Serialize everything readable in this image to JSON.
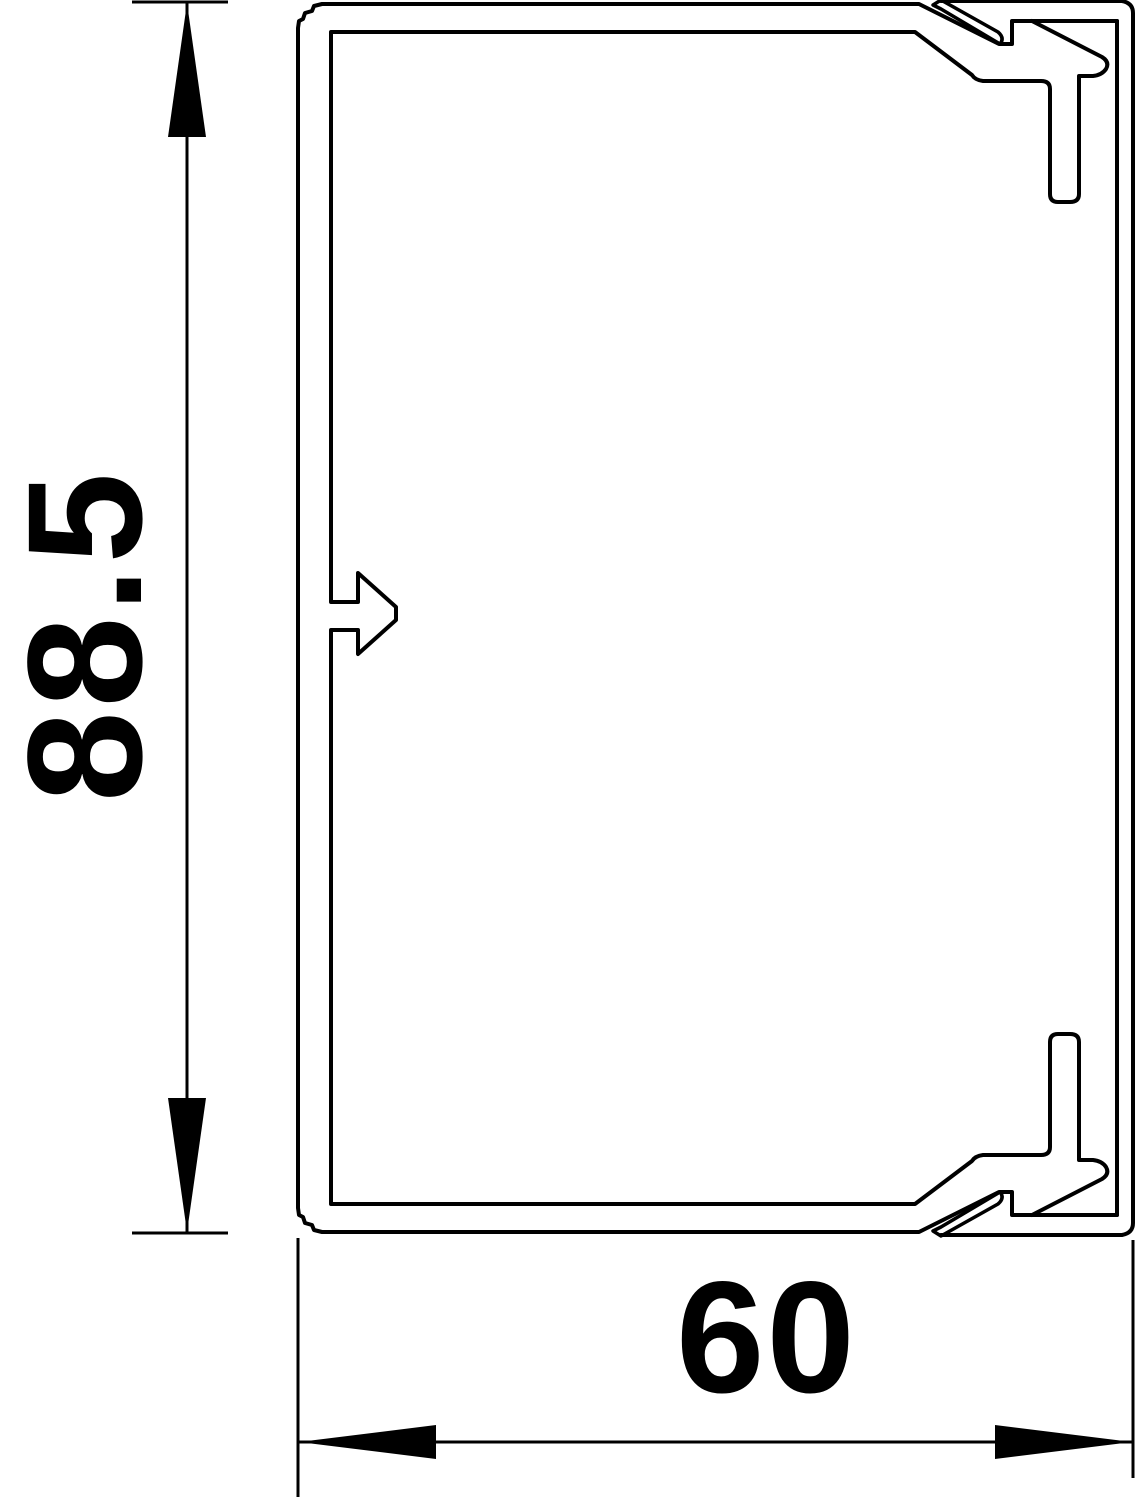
{
  "drawing": {
    "type": "technical cross-section of cable trunking profile with cover",
    "background_color": "#ffffff",
    "line_color": "#000000"
  },
  "dimensions": {
    "height": {
      "label": "88.5",
      "orientation": "vertical"
    },
    "width": {
      "label": "60",
      "orientation": "horizontal"
    }
  }
}
